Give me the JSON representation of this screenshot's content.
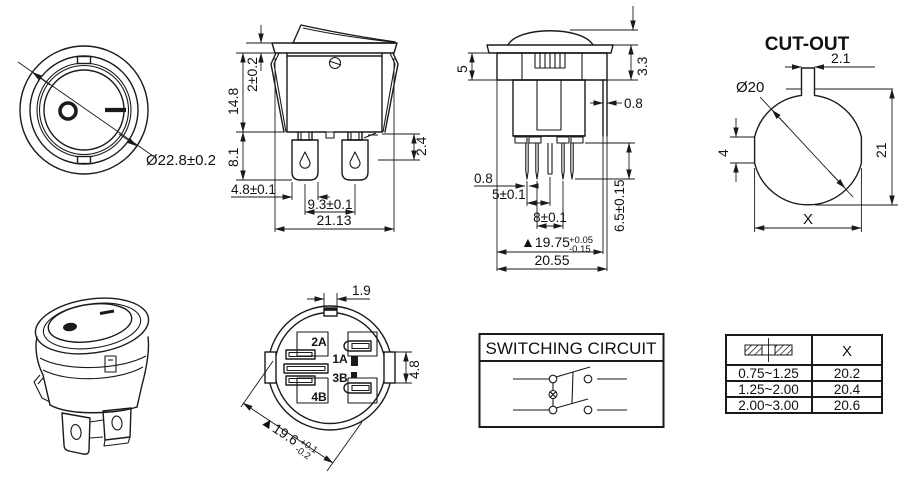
{
  "colors": {
    "ink": "#1a1a1a",
    "background": "#ffffff"
  },
  "views": {
    "top": {
      "diameter": "Ø22.8±0.2"
    },
    "front": {
      "height_upper": "14.8",
      "flange_thickness": "2±0.2",
      "height_lower": "8.1",
      "terminal_width": "4.8±0.1",
      "terminal_pitch": "9.3±0.1",
      "overall_width": "21.13",
      "step": "2.4"
    },
    "side": {
      "upper_height": "5",
      "flange_height": "3.3",
      "wall": "0.8",
      "pin_width": "0.8",
      "pin_pitch_small": "5±0.1",
      "pin_pitch_large": "8±0.1",
      "pin_length": "6.5±0.15",
      "body_width": "▲19.75",
      "body_tol_up": "+0.05",
      "body_tol_down": "-0.15",
      "overall_width": "20.55"
    },
    "cutout": {
      "title": "CUT-OUT",
      "notch_width": "2.1",
      "diameter": "Ø20",
      "flat_height": "4",
      "height": "21",
      "width": "X"
    },
    "bottom": {
      "notch_width": "1.9",
      "tab_height": "4.8",
      "body_width": "▲19.6",
      "body_tol_up": "+0.1",
      "body_tol_down": "-0.2",
      "terminal_1": "2A",
      "terminal_2": "1A",
      "terminal_3": "3B",
      "terminal_4": "4B"
    },
    "circuit": {
      "title": "SWITCHING CIRCUIT"
    },
    "panel_table": {
      "header_x": "X",
      "rows": [
        {
          "thickness": "0.75~1.25",
          "x": "20.2"
        },
        {
          "thickness": "1.25~2.00",
          "x": "20.4"
        },
        {
          "thickness": "2.00~3.00",
          "x": "20.6"
        }
      ]
    }
  }
}
